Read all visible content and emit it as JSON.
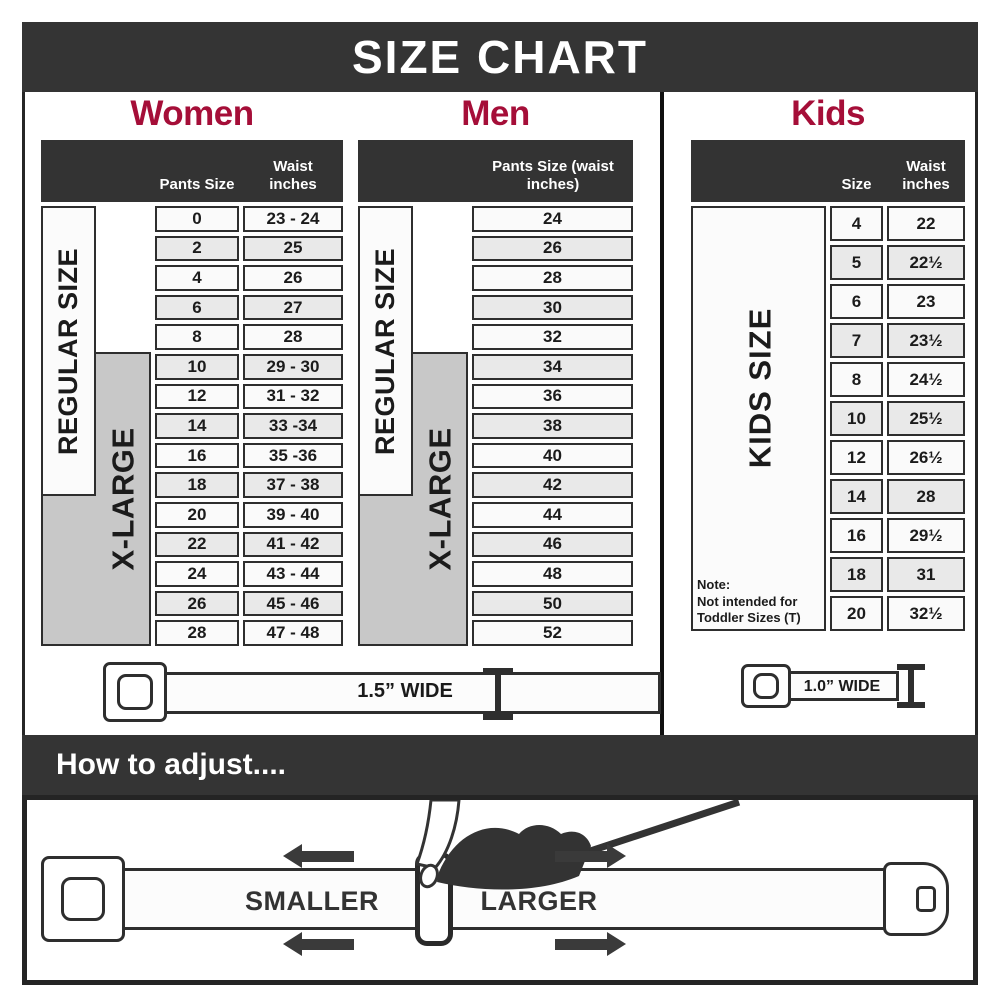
{
  "colors": {
    "accent": "#A50E38",
    "dark": "#343434",
    "band_gray": "#C8C8C8"
  },
  "banner": {
    "title": "SIZE CHART"
  },
  "women": {
    "title": "Women",
    "regular_label": "REGULAR SIZE",
    "xlarge_label": "X-LARGE",
    "size_header": "Pants Size",
    "waist_header": "Waist inches",
    "rows": [
      {
        "size": "0",
        "waist": "23 - 24"
      },
      {
        "size": "2",
        "waist": "25"
      },
      {
        "size": "4",
        "waist": "26"
      },
      {
        "size": "6",
        "waist": "27"
      },
      {
        "size": "8",
        "waist": "28"
      },
      {
        "size": "10",
        "waist": "29 - 30"
      },
      {
        "size": "12",
        "waist": "31 - 32"
      },
      {
        "size": "14",
        "waist": "33 -34"
      },
      {
        "size": "16",
        "waist": "35 -36"
      },
      {
        "size": "18",
        "waist": "37 - 38"
      },
      {
        "size": "20",
        "waist": "39 - 40"
      },
      {
        "size": "22",
        "waist": "41 - 42"
      },
      {
        "size": "24",
        "waist": "43 - 44"
      },
      {
        "size": "26",
        "waist": "45 - 46"
      },
      {
        "size": "28",
        "waist": "47 - 48"
      }
    ]
  },
  "men": {
    "title": "Men",
    "regular_label": "REGULAR SIZE",
    "xlarge_label": "X-LARGE",
    "header": "Pants Size (waist inches)",
    "rows": [
      "24",
      "26",
      "28",
      "30",
      "32",
      "34",
      "36",
      "38",
      "40",
      "42",
      "44",
      "46",
      "48",
      "50",
      "52"
    ]
  },
  "kids": {
    "title": "Kids",
    "side_label": "KIDS SIZE",
    "size_header": "Size",
    "waist_header": "Waist inches",
    "note_title": "Note:",
    "note_line1": "Not intended for",
    "note_line2": "Toddler Sizes (T)",
    "rows": [
      {
        "size": "4",
        "waist": "22"
      },
      {
        "size": "5",
        "waist": "22½"
      },
      {
        "size": "6",
        "waist": "23"
      },
      {
        "size": "7",
        "waist": "23½"
      },
      {
        "size": "8",
        "waist": "24½"
      },
      {
        "size": "10",
        "waist": "25½"
      },
      {
        "size": "12",
        "waist": "26½"
      },
      {
        "size": "14",
        "waist": "28"
      },
      {
        "size": "16",
        "waist": "29½"
      },
      {
        "size": "18",
        "waist": "31"
      },
      {
        "size": "20",
        "waist": "32½"
      }
    ]
  },
  "belts": {
    "adult_width_label": "1.5” WIDE",
    "kids_width_label": "1.0” WIDE"
  },
  "adjust": {
    "heading": "How to adjust....",
    "smaller_label": "SMALLER",
    "larger_label": "LARGER"
  }
}
